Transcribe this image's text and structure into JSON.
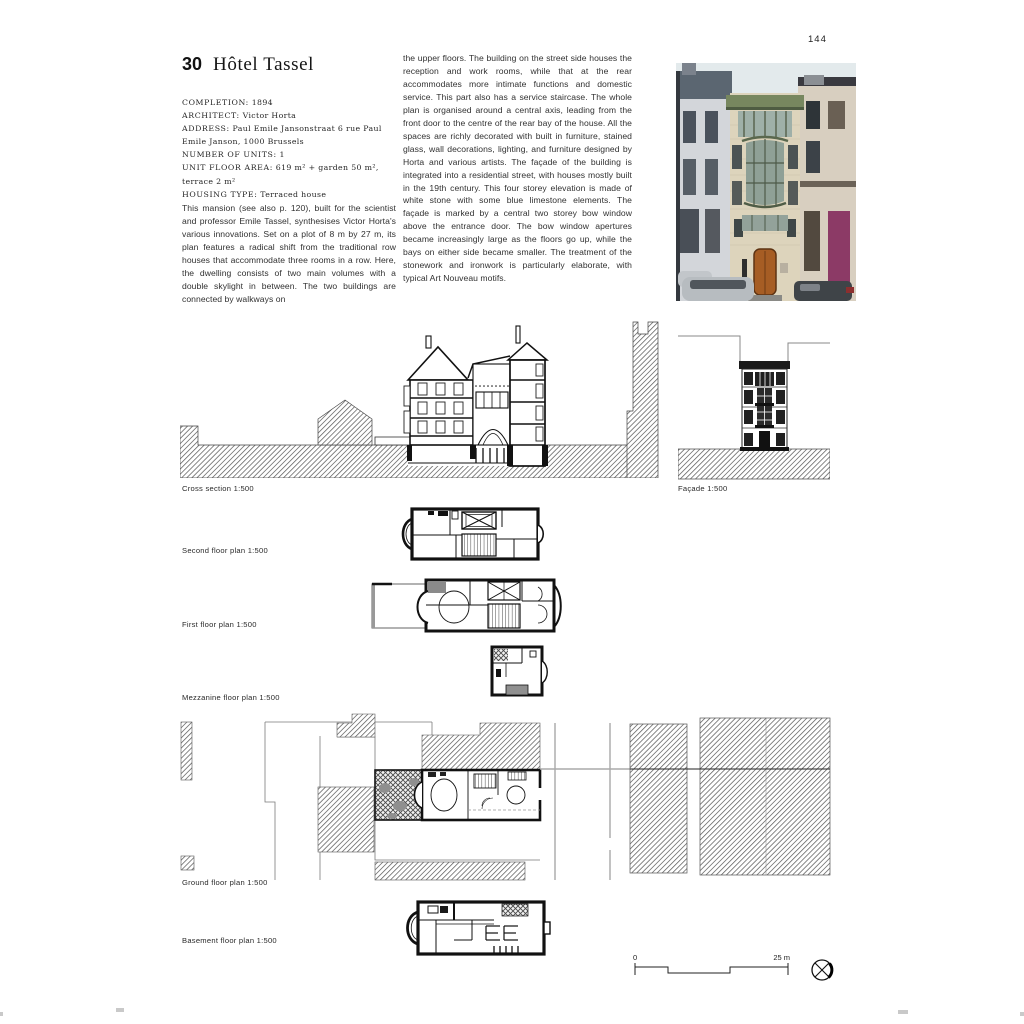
{
  "page_number": "144",
  "header": {
    "number": "30",
    "title": "Hôtel Tassel"
  },
  "meta": {
    "lines": [
      {
        "label": "COMPLETION:",
        "value": " 1894"
      },
      {
        "label": "ARCHITECT:",
        "value": " Victor Horta"
      },
      {
        "label": "ADDRESS:",
        "value": " Paul Emile Jansonstraat 6 rue Paul Emile Janson, 1000 Brussels"
      },
      {
        "label": "NUMBER OF UNITS:",
        "value": " 1"
      },
      {
        "label": "UNIT FLOOR AREA:",
        "value": " 619 m² + garden 50 m², terrace 2 m²"
      },
      {
        "label": "HOUSING TYPE:",
        "value": " Terraced house"
      }
    ]
  },
  "body": {
    "column1": "This mansion (see also p. 120), built for the scientist and professor Emile Tassel, synthesises Victor Horta's various innovations. Set on a plot of 8 m by 27 m, its plan features a radical shift from the traditional row houses that accommodate three rooms in a row. Here, the dwelling consists of two main volumes with a double skylight in between. The two buildings are connected by walkways on",
    "column2": "the upper floors. The building on the street side houses the reception and work rooms, while that at the rear accommodates more intimate functions and domestic service. This part also has a service staircase. The whole plan is organised around a central axis, leading from the front door to the centre of the rear bay of the house. All the spaces are richly decorated with built in furniture, stained glass, wall decorations, lighting, and furniture designed by Horta and various artists. The façade of the building is integrated into a residential street, with houses mostly built in the 19th century. This four storey elevation is made of white stone with some blue limestone elements. The façade is marked by a central two storey bow window above the entrance door. The bow window apertures became increasingly large as the floors go up, while the bays on either side became smaller. The treatment of the stonework and ironwork is particularly elaborate, with typical Art Nouveau motifs."
  },
  "figures": {
    "cross_section": {
      "label": "Cross section 1:500"
    },
    "facade": {
      "label": "Façade 1:500"
    },
    "second_floor": {
      "label": "Second floor plan 1:500"
    },
    "first_floor": {
      "label": "First floor plan 1:500"
    },
    "mezzanine": {
      "label": "Mezzanine floor plan 1:500"
    },
    "ground_floor": {
      "label": "Ground floor plan 1:500"
    },
    "basement": {
      "label": "Basement floor plan 1:500"
    }
  },
  "scale_bar": {
    "start": "0",
    "end": "25 m"
  },
  "icons": {
    "compass": "north-arrow-compass-icon"
  },
  "colors": {
    "ink": "#2d2d2d",
    "hatch_gray": "#5f5f5f",
    "photo_sky": "#e3eaec",
    "photo_stone": "#ddd4bc",
    "photo_green_cornice": "#77875f",
    "photo_entrance_door": "#a65d24",
    "photo_purple_door": "#8c3a66"
  }
}
